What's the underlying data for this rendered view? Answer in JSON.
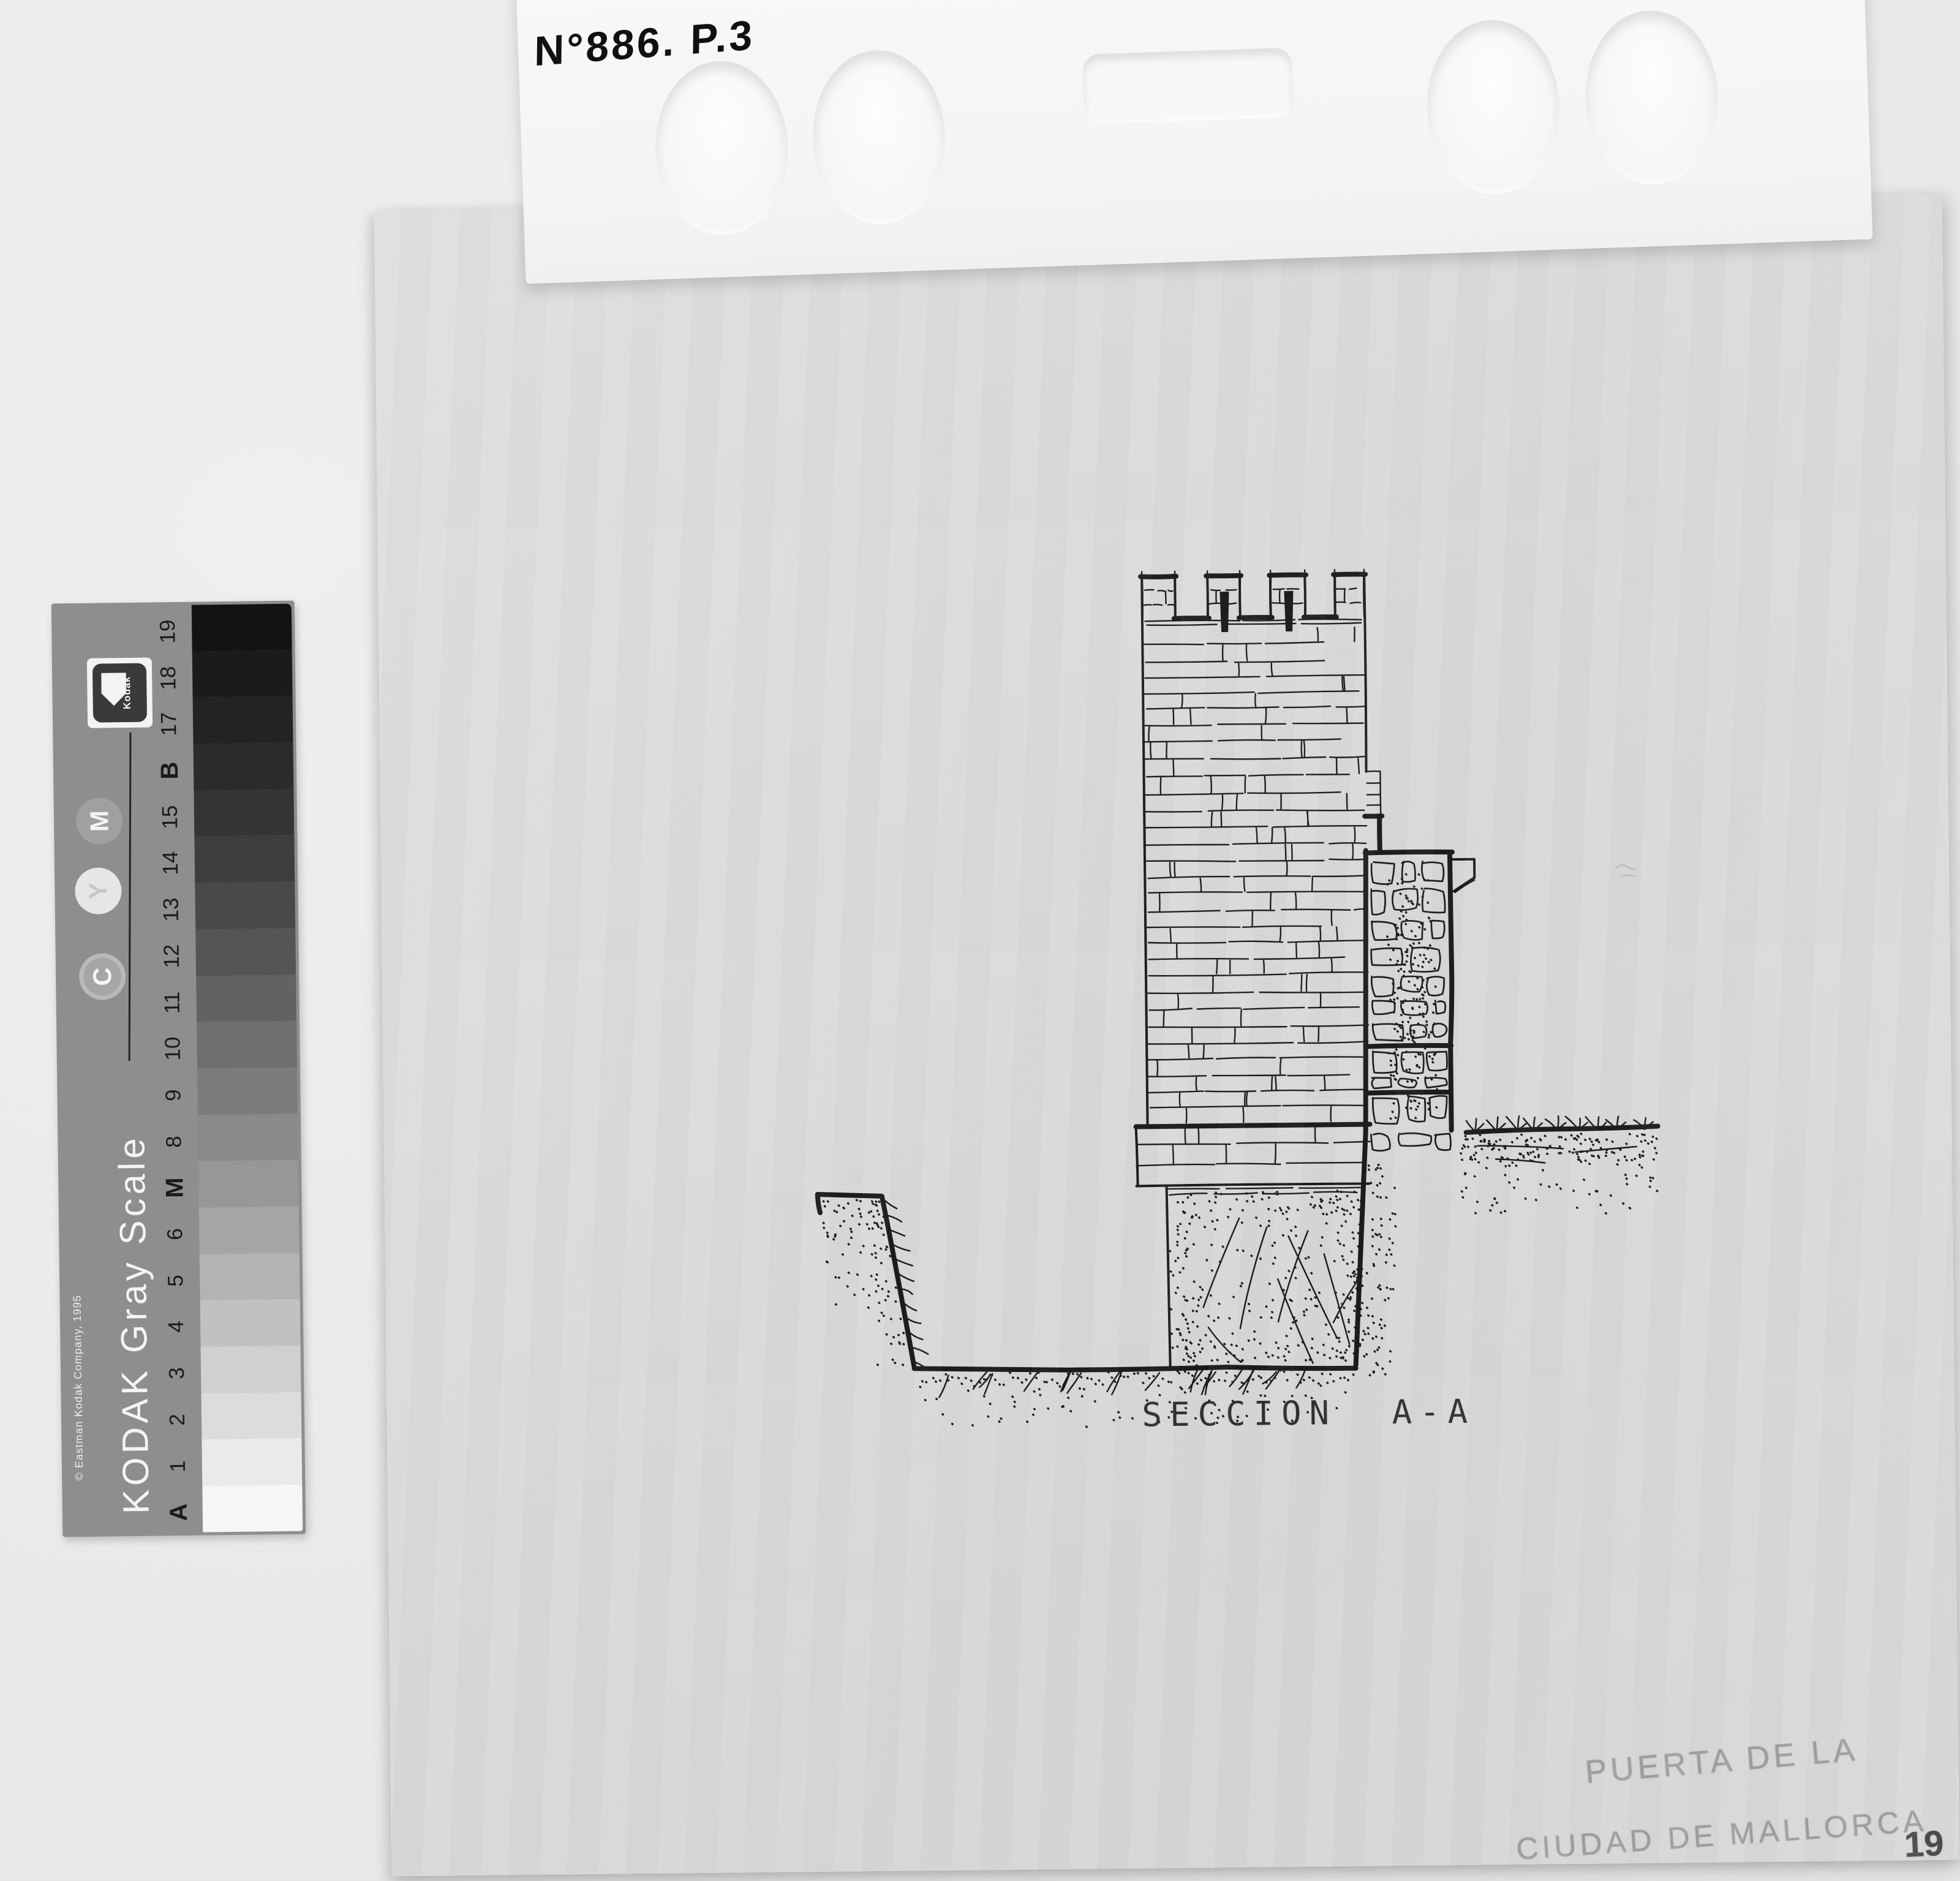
{
  "top_card": {
    "handwritten_label": "N°886. P.3"
  },
  "kodak_strip": {
    "brand_logo_text": "Kodak",
    "scale_title": "KODAK Gray Scale",
    "copyright": "© Eastman Kodak Company, 1995",
    "dye_patches": [
      {
        "label": "M"
      },
      {
        "label": "Y"
      },
      {
        "label": "C"
      }
    ],
    "patches_top_to_bottom": [
      {
        "label": "19",
        "bold": false,
        "color": "#131311"
      },
      {
        "label": "18",
        "bold": false,
        "color": "#1b1b19"
      },
      {
        "label": "17",
        "bold": false,
        "color": "#232321"
      },
      {
        "label": "B",
        "bold": true,
        "color": "#2b2b29"
      },
      {
        "label": "15",
        "bold": false,
        "color": "#343432"
      },
      {
        "label": "14",
        "bold": false,
        "color": "#3e3e3c"
      },
      {
        "label": "13",
        "bold": false,
        "color": "#494947"
      },
      {
        "label": "12",
        "bold": false,
        "color": "#555553"
      },
      {
        "label": "11",
        "bold": false,
        "color": "#626260"
      },
      {
        "label": "10",
        "bold": false,
        "color": "#6f6f6d"
      },
      {
        "label": "9",
        "bold": false,
        "color": "#7c7c7a"
      },
      {
        "label": "8",
        "bold": false,
        "color": "#8a8a88"
      },
      {
        "label": "M",
        "bold": true,
        "color": "#979795"
      },
      {
        "label": "6",
        "bold": false,
        "color": "#a5a5a3"
      },
      {
        "label": "5",
        "bold": false,
        "color": "#b3b3b1"
      },
      {
        "label": "4",
        "bold": false,
        "color": "#c1c1bf"
      },
      {
        "label": "3",
        "bold": false,
        "color": "#d0d0ce"
      },
      {
        "label": "2",
        "bold": false,
        "color": "#dcdcda"
      },
      {
        "label": "1",
        "bold": false,
        "color": "#eaeae8"
      },
      {
        "label": "A",
        "bold": true,
        "color": "#f6f6f4"
      }
    ]
  },
  "drawing": {
    "caption": "SECCION A-A"
  },
  "pencil_annotations": {
    "line1": "PUERTA DE LA",
    "line2": "CIUDAD DE MALLORCA"
  },
  "page_number": "19"
}
